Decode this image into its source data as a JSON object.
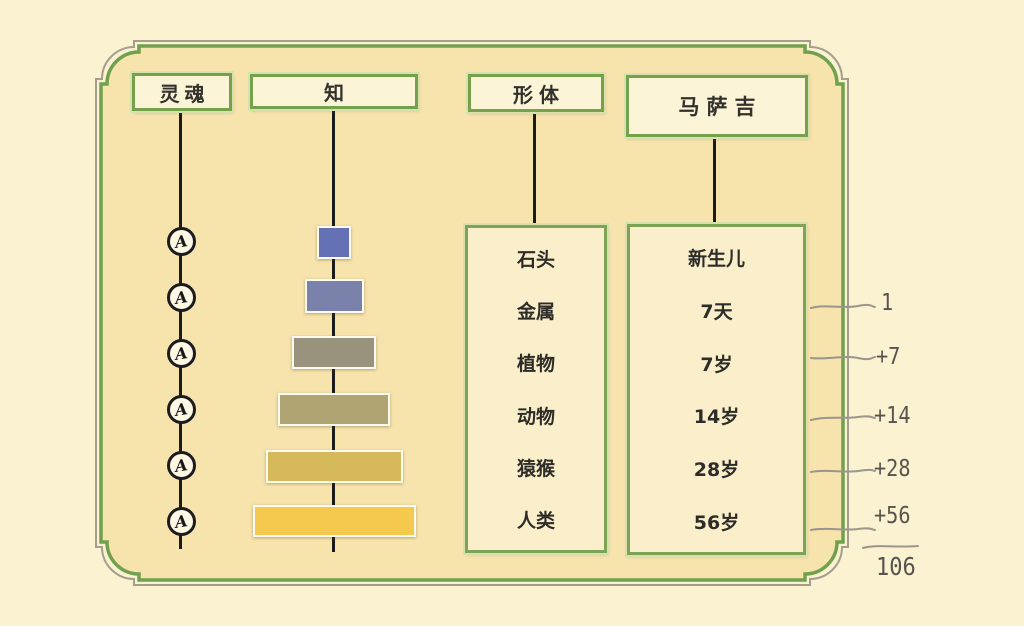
{
  "headers": {
    "soul": "灵魂",
    "knowledge": "知",
    "form": "形体",
    "masaji": "马萨吉"
  },
  "soul": {
    "glyph": "A",
    "node_count": 6
  },
  "pyramid": {
    "levels": [
      {
        "order": 1,
        "color": "#6471b5",
        "css": "background:#6471b5"
      },
      {
        "order": 2,
        "color": "#7a82ac",
        "css": "background:#7a82ac"
      },
      {
        "order": 3,
        "color": "#99937e",
        "css": "background:#99937e"
      },
      {
        "order": 4,
        "color": "#b1a473",
        "css": "background:#b1a473"
      },
      {
        "order": 5,
        "color": "#d6b95a",
        "css": "background:#d6b95a"
      },
      {
        "order": 6,
        "color": "#f4c94e",
        "css": "background:#f4c94e"
      }
    ]
  },
  "form_rows": [
    "石头",
    "金属",
    "植物",
    "动物",
    "猿猴",
    "人类"
  ],
  "masaji_rows": [
    "新生儿",
    "7天",
    "7岁",
    "14岁",
    "28岁",
    "56岁"
  ],
  "margin_notes": {
    "ticks": [
      "1",
      "+7",
      "+14",
      "+28",
      "+56"
    ],
    "total": "106"
  },
  "palette": {
    "page_bg": "#fbf2d1",
    "frame_inner_bg": "#f7e3ac",
    "frame_green": "#71a14e",
    "frame_outline_gray": "#a69e8c",
    "header_box_fill": "#fcf4d6",
    "header_box_border": "#76a14b",
    "panel_fill": "#faefca",
    "connector_black": "#1b1b1b",
    "note_gray": "#57544d",
    "tick_gray": "#9b968c"
  }
}
